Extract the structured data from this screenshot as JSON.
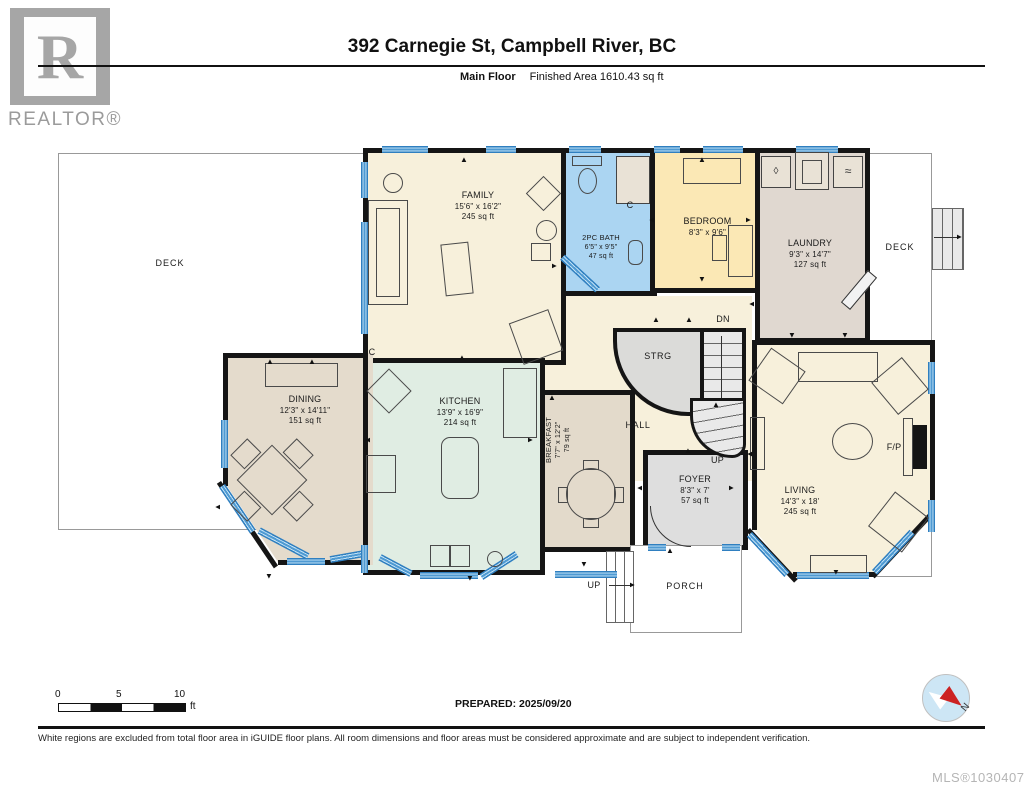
{
  "header": {
    "title": "392 Carnegie St, Campbell River, BC",
    "floor_label": "Main Floor",
    "area_label": "Finished Area 1610.43 sq ft",
    "logo_letter": "R",
    "logo_text": "REALTOR®"
  },
  "rooms": {
    "deck_left": {
      "name": "DECK"
    },
    "deck_right": {
      "name": "DECK"
    },
    "family": {
      "name": "FAMILY",
      "dims": "15'6\" x 16'2\"",
      "area": "245 sq ft"
    },
    "bath": {
      "name": "2PC BATH",
      "dims": "6'5\" x 9'5\"",
      "area": "47 sq ft"
    },
    "bedroom": {
      "name": "BEDROOM",
      "dims": "8'3\" x 9'6\""
    },
    "laundry": {
      "name": "LAUNDRY",
      "dims": "9'3\" x 14'7\"",
      "area": "127 sq ft"
    },
    "strg": {
      "name": "STRG"
    },
    "hall": {
      "name": "HALL"
    },
    "kitchen": {
      "name": "KITCHEN",
      "dims": "13'9\" x 16'9\"",
      "area": "214 sq ft"
    },
    "breakfast": {
      "name": "BREAKFAST",
      "dims": "7'7\" x 12'2\"",
      "area": "79 sq ft"
    },
    "dining": {
      "name": "DINING",
      "dims": "12'3\" x 14'11\"",
      "area": "151 sq ft"
    },
    "foyer": {
      "name": "FOYER",
      "dims": "8'3\" x 7'",
      "area": "57 sq ft"
    },
    "living": {
      "name": "LIVING",
      "dims": "14'3\" x 18'",
      "area": "245 sq ft"
    },
    "porch": {
      "name": "PORCH"
    }
  },
  "labels": {
    "stairs_dn": "DN",
    "stairs_up": "UP",
    "stairs_up_ext": "UP",
    "closet": "C",
    "fireplace": "F/P"
  },
  "icons": {
    "door_arrow": "▲",
    "washer_drop": "◊",
    "dryer_wave": "≈"
  },
  "compass": {
    "north_label": "N"
  },
  "scale_bar": {
    "tick_0": "0",
    "tick_5": "5",
    "tick_10": "10",
    "unit": "ft"
  },
  "prepared_label": "PREPARED: 2025/09/20",
  "footer": {
    "disclaimer": "White regions are excluded from total floor area in iGUIDE floor plans. All room dimensions and floor areas must be considered approximate and are subject to independent verification.",
    "mls": "MLS®1030407"
  },
  "colors": {
    "wall": "#151515",
    "window_blue": "#4f9ad2",
    "family_cream": "#f7f0db",
    "bath_blue": "#abd5f2",
    "bedroom_yellow": "#fbe8b5",
    "laundry_taupe": "#e0d8d0",
    "kitchen_mint": "#e0ede3",
    "dining_tan": "#e4dbcc",
    "foyer_gray": "#dedede",
    "stair_gray": "#e9e9e9",
    "compass_red": "#cc2222",
    "compass_blue": "#cde6f5",
    "logo_gray": "#a6a6a6"
  }
}
